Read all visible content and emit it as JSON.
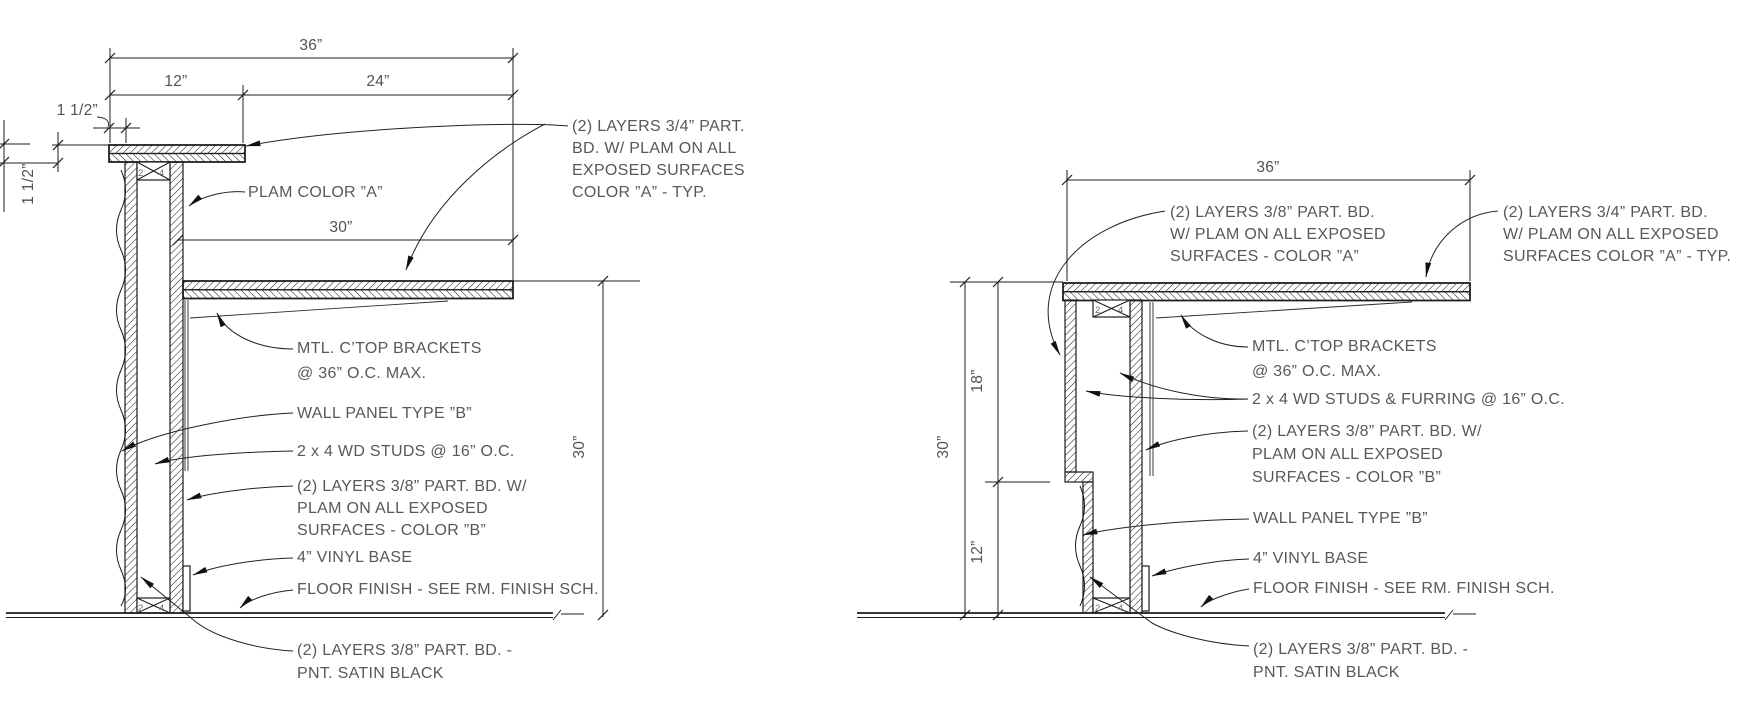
{
  "page": {
    "background": "#ffffff",
    "line_color": "#1c1c1c",
    "text_color": "#585858"
  },
  "left_detail": {
    "dims": {
      "w36": "36”",
      "w12": "12”",
      "w24": "24”",
      "h1a": "1 1/2”",
      "h1b": "1 1/2”",
      "d30_top": "30”",
      "d30_side": "30”"
    },
    "stud": {
      "n2": "2",
      "n4": "4"
    },
    "labels": {
      "top_layers": [
        "(2) LAYERS 3/4” PART.",
        "BD. W/ PLAM ON ALL",
        "EXPOSED SURFACES",
        "COLOR ”A” - TYP."
      ],
      "plam": "PLAM COLOR ”A”",
      "brackets": [
        "MTL. C’TOP BRACKETS",
        "@ 36” O.C. MAX."
      ],
      "wall_panel": "WALL PANEL TYPE ”B”",
      "studs": "2 x 4 WD STUDS @ 16” O.C.",
      "layers_b": [
        "(2) LAYERS 3/8” PART. BD. W/",
        "PLAM ON ALL EXPOSED",
        "SURFACES - COLOR ”B”"
      ],
      "vinyl": "4” VINYL BASE",
      "floor": "FLOOR FINISH - SEE RM. FINISH SCH.",
      "satin": [
        "(2) LAYERS 3/8” PART. BD. -",
        "PNT. SATIN BLACK"
      ]
    }
  },
  "right_detail": {
    "dims": {
      "w36": "36”",
      "v30": "30”",
      "v18": "18”",
      "v12": "12”"
    },
    "stud": {
      "n2": "2",
      "n4": "4"
    },
    "labels": {
      "top_layers": [
        "(2) LAYERS 3/8” PART. BD.",
        "W/ PLAM ON ALL EXPOSED",
        "SURFACES - COLOR ”A”"
      ],
      "right_layers": [
        "(2) LAYERS 3/4” PART. BD.",
        "W/ PLAM ON ALL EXPOSED",
        "SURFACES COLOR ”A” - TYP."
      ],
      "brackets": [
        "MTL. C’TOP BRACKETS",
        "@ 36” O.C. MAX."
      ],
      "studs_furring": "2 x 4 WD STUDS & FURRING @ 16” O.C.",
      "layers_b": [
        "(2) LAYERS 3/8” PART. BD. W/",
        "PLAM ON ALL EXPOSED",
        "SURFACES - COLOR ”B”"
      ],
      "wall_panel": "WALL PANEL TYPE ”B”",
      "vinyl": "4” VINYL BASE",
      "floor": "FLOOR FINISH - SEE RM. FINISH SCH.",
      "satin": [
        "(2) LAYERS 3/8” PART. BD. -",
        "PNT. SATIN BLACK"
      ]
    }
  }
}
